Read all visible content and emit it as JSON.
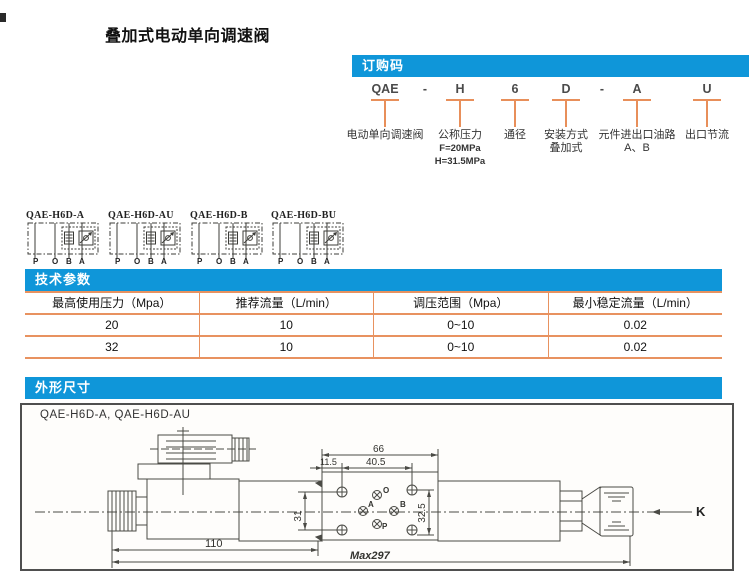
{
  "colors": {
    "accent_blue": "#0f96d9",
    "line_orange": "#e88f5a",
    "drawing_line": "#4a4a45"
  },
  "page": {
    "title": "叠加式电动单向调速阀"
  },
  "order_code": {
    "header": "订购码",
    "codes": {
      "c0": "QAE",
      "d0": "-",
      "c1": "H",
      "c2": "6",
      "c3": "D",
      "d1": "-",
      "c4": "A",
      "c5": "U"
    },
    "labels": {
      "l0": "电动单向调速阀",
      "l1": "公称压力",
      "l1s1": "F=20MPa",
      "l1s2": "H=31.5MPa",
      "l2": "通径",
      "l3": "安装方式",
      "l3s1": "叠加式",
      "l4": "元件进出口油路",
      "l4s1": "A、B",
      "l5": "出口节流"
    }
  },
  "schematics": {
    "items": [
      {
        "label": "QAE-H6D-A"
      },
      {
        "label": "QAE-H6D-AU"
      },
      {
        "label": "QAE-H6D-B"
      },
      {
        "label": "QAE-H6D-BU"
      }
    ],
    "ports": {
      "p": "P",
      "o": "O",
      "b": "B",
      "a": "A"
    }
  },
  "tech_params": {
    "header": "技术参数",
    "columns": [
      "最高使用压力（Mpa）",
      "推荐流量（L/min）",
      "调压范围（Mpa）",
      "最小稳定流量（L/min）"
    ],
    "rows": [
      {
        "c0": "20",
        "c1": "10",
        "c2": "0~10",
        "c3": "0.02"
      },
      {
        "c0": "32",
        "c1": "10",
        "c2": "0~10",
        "c3": "0.02"
      }
    ]
  },
  "chart_data": {
    "type": "table",
    "title": "技术参数",
    "columns": [
      "最高使用压力（Mpa）",
      "推荐流量（L/min）",
      "调压范围（Mpa）",
      "最小稳定流量（L/min）"
    ],
    "rows": [
      [
        "20",
        "10",
        "0~10",
        "0.02"
      ],
      [
        "32",
        "10",
        "0~10",
        "0.02"
      ]
    ]
  },
  "outline": {
    "header": "外形尺寸",
    "figure_label": "QAE-H6D-A, QAE-H6D-AU",
    "dims": {
      "plate_width": "66",
      "hole_span": "40.5",
      "edge_offset": "11.5",
      "left_height": "31",
      "right_height": "32.5",
      "body_length": "110",
      "max_length": "Max297",
      "view_label": "K"
    },
    "ports": {
      "o": "O",
      "a": "A",
      "b": "B",
      "p": "P"
    }
  }
}
